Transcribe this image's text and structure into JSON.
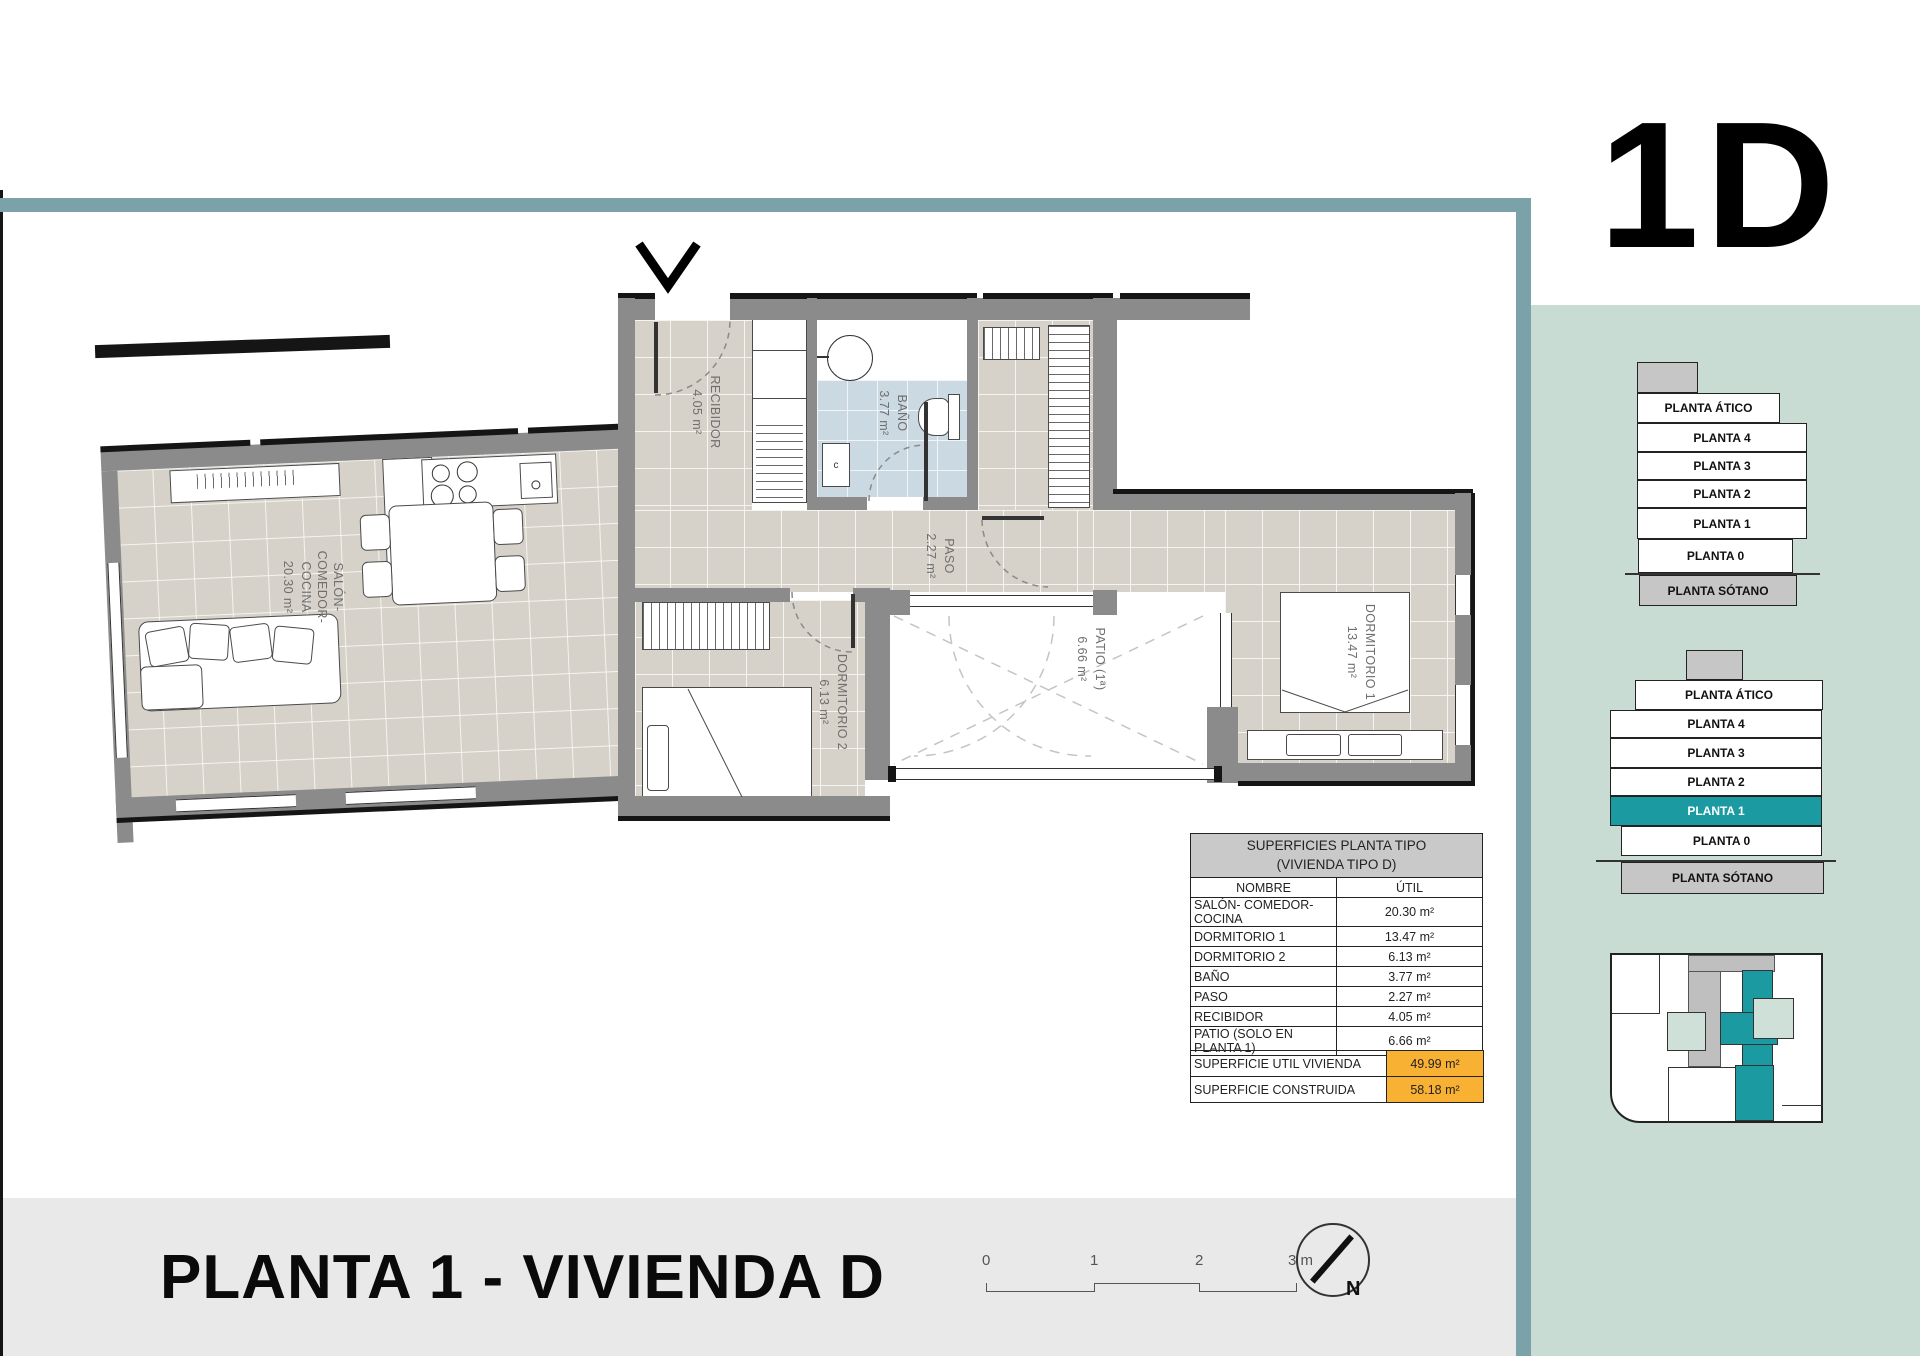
{
  "unit_code": "1D",
  "page_title": "PLANTA 1 - VIVIENDA D",
  "colors": {
    "accent_teal": "#1B9AA1",
    "band_teal": "#7BA2A9",
    "panel_mint": "#C9DCD4",
    "highlight_orange": "#F8B133",
    "floor_beige": "#D6D2C9",
    "bath_blue": "#CBD9E3",
    "wall_grey": "#8B8B8B"
  },
  "plan": {
    "rooms": {
      "salon": {
        "label": "SALÓN-\nCOMEDOR-\nCOCINA",
        "area": "20.30 m²"
      },
      "recibidor": {
        "label": "RECIBIDOR",
        "area": "4.05 m²"
      },
      "bano": {
        "label": "BAÑO",
        "area": "3.77 m²"
      },
      "paso": {
        "label": "PASO",
        "area": "2.27 m²"
      },
      "dormitorio2": {
        "label": "DORMITORIO 2",
        "area": "6.13 m²"
      },
      "dormitorio1": {
        "label": "DORMITORIO 1",
        "area": "13.47 m²"
      },
      "patio": {
        "label": "PATIO (1ª)",
        "area": "6.66 m²"
      }
    },
    "washer_label": "c"
  },
  "areas_table": {
    "title_line1": "SUPERFICIES PLANTA TIPO",
    "title_line2": "(VIVIENDA TIPO D)",
    "col_name": "NOMBRE",
    "col_util": "ÚTIL",
    "rows": [
      {
        "name": "SALÓN- COMEDOR- COCINA",
        "util": "20.30 m²"
      },
      {
        "name": "DORMITORIO 1",
        "util": "13.47 m²"
      },
      {
        "name": "DORMITORIO 2",
        "util": "6.13 m²"
      },
      {
        "name": "BAÑO",
        "util": "3.77 m²"
      },
      {
        "name": "PASO",
        "util": "2.27 m²"
      },
      {
        "name": "RECIBIDOR",
        "util": "4.05 m²"
      },
      {
        "name": "PATIO (SOLO EN PLANTA 1)",
        "util": "6.66 m²"
      }
    ],
    "summary": [
      {
        "name": "SUPERFICIE UTIL VIVIENDA",
        "util": "49.99 m²"
      },
      {
        "name": "SUPERFICIE CONSTRUIDA",
        "util": "58.18 m²"
      }
    ]
  },
  "stack_top": {
    "levels": [
      "PLANTA ÁTICO",
      "PLANTA 4",
      "PLANTA 3",
      "PLANTA 2",
      "PLANTA 1",
      "PLANTA 0",
      "PLANTA SÓTANO"
    ]
  },
  "stack_bottom": {
    "levels": [
      "PLANTA ÁTICO",
      "PLANTA 4",
      "PLANTA 3",
      "PLANTA 2",
      "PLANTA 1",
      "PLANTA 0",
      "PLANTA SÓTANO"
    ],
    "highlighted": "PLANTA 1"
  },
  "scale_bar": {
    "t0": "0",
    "t1": "1",
    "t2": "2",
    "t3": "3 m"
  },
  "north_label": "N"
}
